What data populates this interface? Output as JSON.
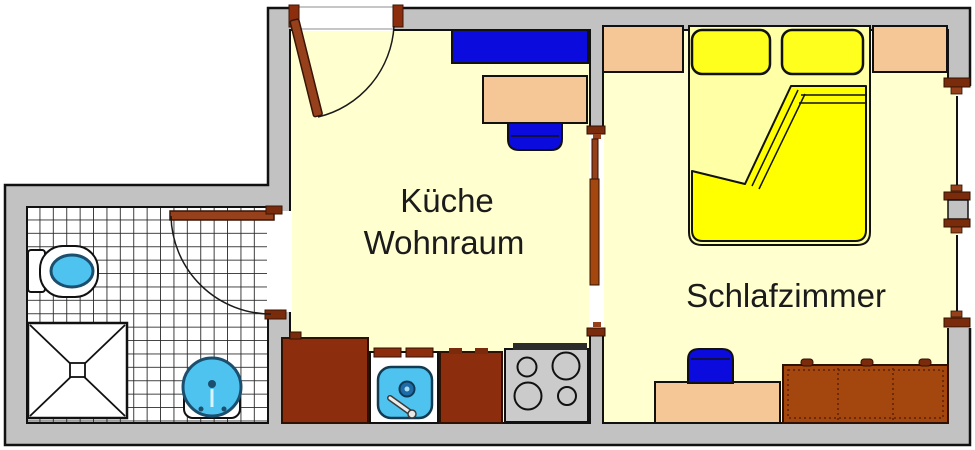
{
  "labels": {
    "kitchen_line1": "Küche",
    "kitchen_line2": "Wohnraum",
    "bedroom": "Schlafzimmer"
  },
  "colors": {
    "wall": "#C2C2C2",
    "floor": "#FFFFD0",
    "tile-line": "#2A2A2A",
    "furniture-blue": "#0B0BDD",
    "fixture-cyan": "#4EC3EF",
    "fixture-cyan-stroke": "#1C4E6E",
    "counter-brown": "#8C2E0E",
    "door-brown": "#96411C",
    "cap-brown": "#7A2B0C",
    "wardrobe-brown": "#A3470E",
    "bed-yellow": "#FFFF00",
    "pillow-yellow": "#FFFF1E",
    "bed-pale": "#FFFFA6",
    "furniture-peach": "#F6C796",
    "stove-gray": "#CBCBCB",
    "outline": "#111111"
  },
  "fixtures": {
    "bathroom": [
      "toilet",
      "shower",
      "washbasin",
      "swing-door",
      "tiled-floor"
    ],
    "kitchen_living": [
      "entrance-door",
      "sideboard",
      "dining-table",
      "chair",
      "base-cabinet-left",
      "kitchen-sink-unit",
      "base-cabinet-mid",
      "stove-4-burners"
    ],
    "bedroom": [
      "double-bed",
      "pillow-left",
      "pillow-right",
      "folded-duvet",
      "nightstand-left",
      "nightstand-right",
      "desk",
      "desk-chair",
      "wardrobe",
      "double-window",
      "sliding-door"
    ]
  }
}
